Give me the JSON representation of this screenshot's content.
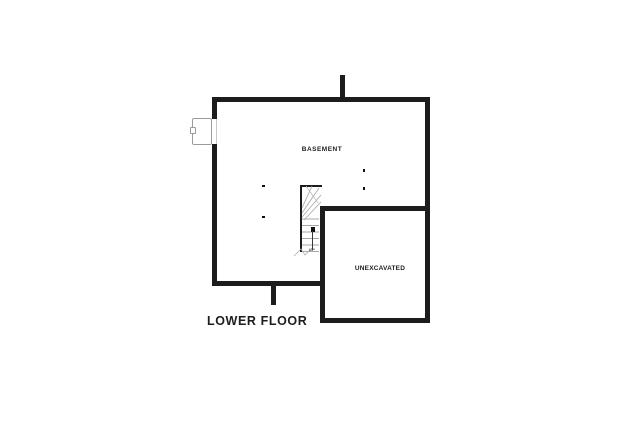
{
  "floorplan": {
    "title": "LOWER FLOOR",
    "rooms": {
      "basement": {
        "label": "BASEMENT"
      },
      "unexcavated": {
        "label": "UNEXCAVATED"
      }
    },
    "stairs": {
      "direction_label": "UP"
    },
    "colors": {
      "background": "#ffffff",
      "wall": "#1c1c1c",
      "thin_line": "#9b9b9b",
      "tread_line": "#a8a8a8",
      "text": "#1d1d1d"
    }
  }
}
